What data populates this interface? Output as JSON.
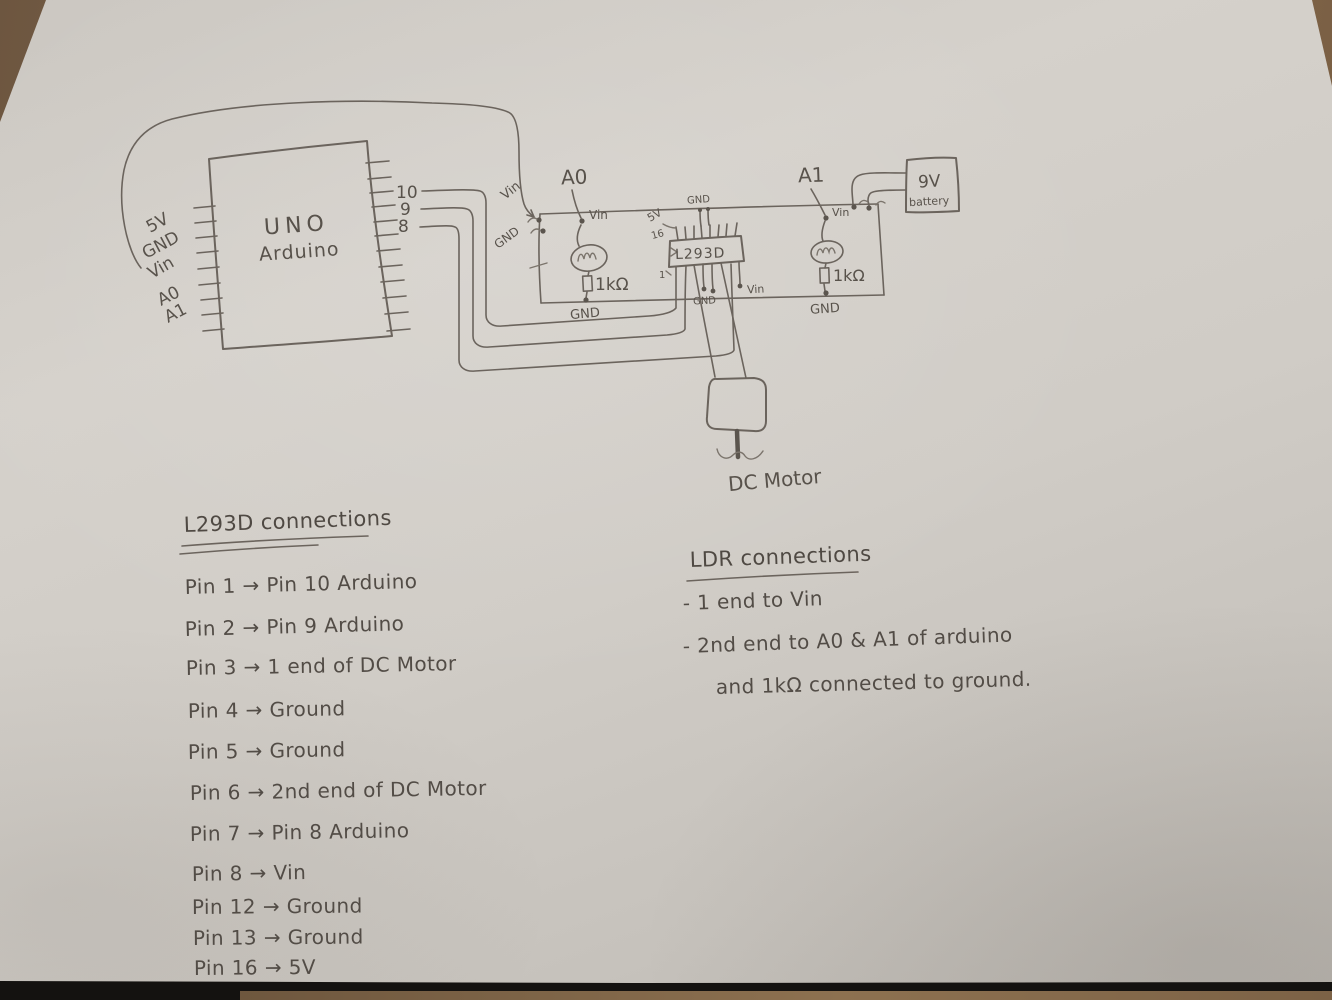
{
  "colors": {
    "pencil": "#6b645d",
    "text": "#56504a",
    "paper": "#cfcbc5",
    "wood": "#7d6249"
  },
  "diagram": {
    "arduino": {
      "name_line1": "UNO",
      "name_line2": "Arduino",
      "left_pins": [
        "5V",
        "GND",
        "Vin",
        "A0",
        "A1"
      ],
      "right_pins": [
        "10",
        "9",
        "8"
      ]
    },
    "bus": {
      "vin": "Vin",
      "gnd": "GND"
    },
    "ldr_a0": {
      "label": "A0",
      "vin": "Vin",
      "resistor": "1kΩ",
      "gnd": "GND"
    },
    "ldr_a1": {
      "label": "A1",
      "vin": "Vin",
      "resistor": "1kΩ",
      "gnd": "GND"
    },
    "l293d": {
      "label": "L293D",
      "pin16": "16",
      "supply": "5V",
      "top_gnd": "GND",
      "pin1": "1",
      "bottom_gnd": "GND",
      "vin": "Vin"
    },
    "battery": {
      "line1": "9V",
      "line2": "battery"
    },
    "motor": {
      "label": "DC Motor"
    }
  },
  "notes": {
    "l293d": {
      "heading": "L293D connections",
      "items": [
        "Pin 1 → Pin 10 Arduino",
        "Pin 2 → Pin 9 Arduino",
        "Pin 3 → 1 end of DC Motor",
        "Pin 4 → Ground",
        "Pin 5 → Ground",
        "Pin 6 → 2nd end of DC Motor",
        "Pin 7 → Pin 8 Arduino",
        "Pin 8 → Vin",
        "Pin 12 → Ground",
        "Pin 13 → Ground",
        "Pin 16 → 5V"
      ]
    },
    "ldr": {
      "heading": "LDR connections",
      "items": [
        "- 1 end to Vin",
        "- 2nd end to A0 & A1 of arduino",
        "and 1kΩ connected to ground."
      ]
    }
  }
}
